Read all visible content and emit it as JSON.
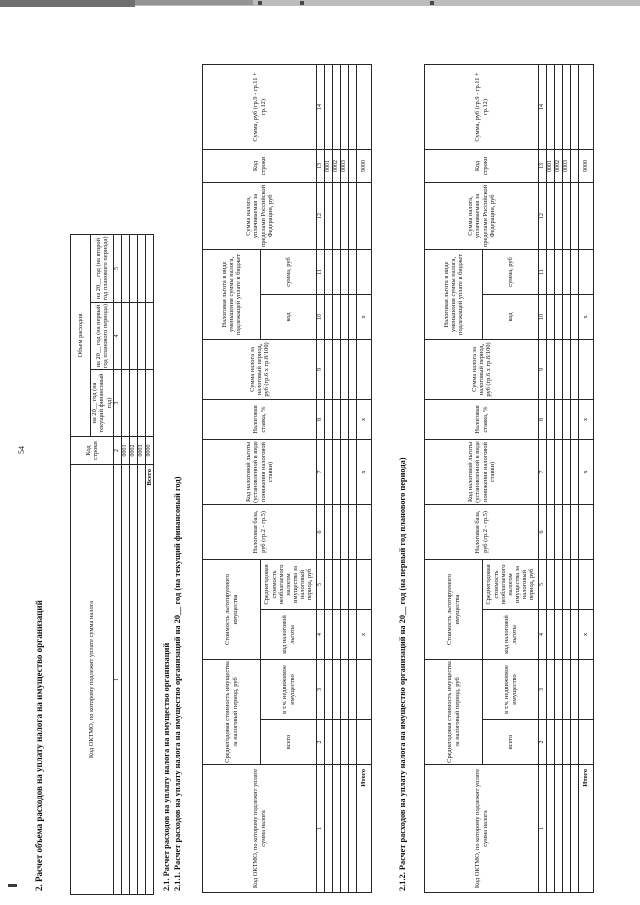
{
  "page": {
    "number": "54",
    "section_title": "2. Расчет объема расходов на уплату налога на имущество организаций",
    "subtitle_21": "2.1. Расчет расходов на уплату налога на имущество организаций",
    "subtitle_211": "2.1.1. Расчет расходов на уплату налога на имущество организаций на 20__ год (на текущий финансовый год)",
    "subtitle_212": "2.1.2. Расчет расходов на уплату налога на имущество организаций на 20__ год (на первый год планового периода)"
  },
  "expense_table": {
    "col_oktmo": "Код ОКТМО, по которому подлежит уплате сумма налога",
    "col_line_code": "Код строки",
    "group_expenses": "Объем расходов",
    "col_year_current": "на 20__ год (на текущий финансовый год)",
    "col_year_first": "на 20__ год (на первый год планового периода)",
    "col_year_second": "на 20__ год (на второй год планового периода)",
    "col_numbers": [
      "1",
      "2",
      "3",
      "4",
      "5"
    ],
    "row_codes": [
      "0001",
      "0002",
      "0003"
    ],
    "total_label": "Всего",
    "total_code": "9000"
  },
  "calc_table": {
    "col1": "Код ОКТМО, по которому подлежит уплате сумма налога",
    "group_avg_value": "Среднегодовая стоимость имущества за налоговый период, руб",
    "col2": "всего",
    "col3": "в т.ч. недвижимое имущество",
    "group_exempt_value": "Стоимость льготируемого имущества",
    "col4": "код налоговой льготы",
    "col5": "Среднегодовая стоимость необлагаемого налогом имущества за налоговый период, руб",
    "col6": "Налоговая база, руб (гр.2 - гр.5)",
    "col7": "Код налоговой льготы (установленной в виде понижения налоговой ставки)",
    "col8": "Налоговая ставка, %",
    "col9": "Сумма налога за налоговый период, руб (гр.6 х гр.8/100)",
    "group_benefit": "Налоговая льгота в виде уменьшения суммы налога, подлежащей уплате в бюджет",
    "col10": "код",
    "col11": "сумма, руб",
    "col12": "Сумма налога, уплачиваемая за пределами Российской Федерации, руб",
    "col13": "Код строки",
    "col14": "Сумма, руб (гр.9 - гр.11 + гр.12)",
    "col_numbers": [
      "1",
      "2",
      "3",
      "4",
      "5",
      "6",
      "7",
      "8",
      "9",
      "10",
      "11",
      "12",
      "13",
      "14"
    ],
    "row_codes": [
      "0001",
      "0002",
      "0003"
    ],
    "total_label": "Итого",
    "total_code": "9000",
    "x_mark": "х"
  }
}
